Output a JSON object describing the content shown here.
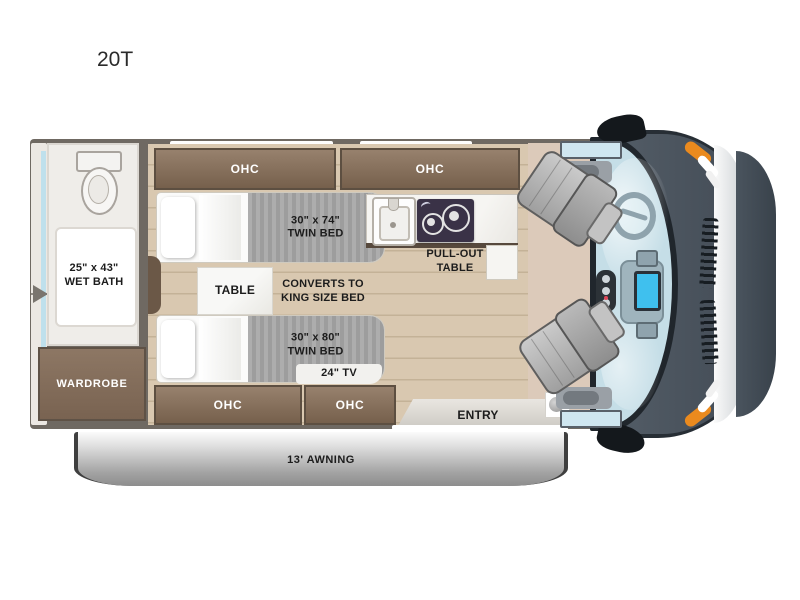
{
  "title": "20T",
  "cabinets": {
    "ohc_label": "OHC"
  },
  "wet_bath": {
    "size": "25\" x 43\"",
    "name": "WET BATH"
  },
  "wardrobe": {
    "label": "WARDROBE"
  },
  "beds": {
    "top": {
      "size": "30\" x 74\"",
      "name": "TWIN BED"
    },
    "bottom": {
      "size": "30\" x 80\"",
      "name": "TWIN BED"
    },
    "converts_line1": "CONVERTS TO",
    "converts_line2": "KING SIZE BED"
  },
  "table": {
    "label": "TABLE"
  },
  "kitchen": {
    "pullout_line1": "PULL-OUT",
    "pullout_line2": "TABLE"
  },
  "tv": {
    "label": "24\" TV"
  },
  "entry": {
    "label": "ENTRY"
  },
  "awning": {
    "label": "13' AWNING"
  },
  "colors": {
    "wall": "#6f6962",
    "cabinet_wood": "#8a7360",
    "floor_wood": "#d9c8b0",
    "cab_floor": "#dccaba",
    "mattress_gray": "#a5a5a5",
    "van_body": "#49525c",
    "windshield_blue": "#c5dee7",
    "accent_orange": "#ea8a1e",
    "screen_blue": "#3fc0ee",
    "stove_dark": "#3a3247",
    "awning_gray": "#9a9a9a"
  }
}
